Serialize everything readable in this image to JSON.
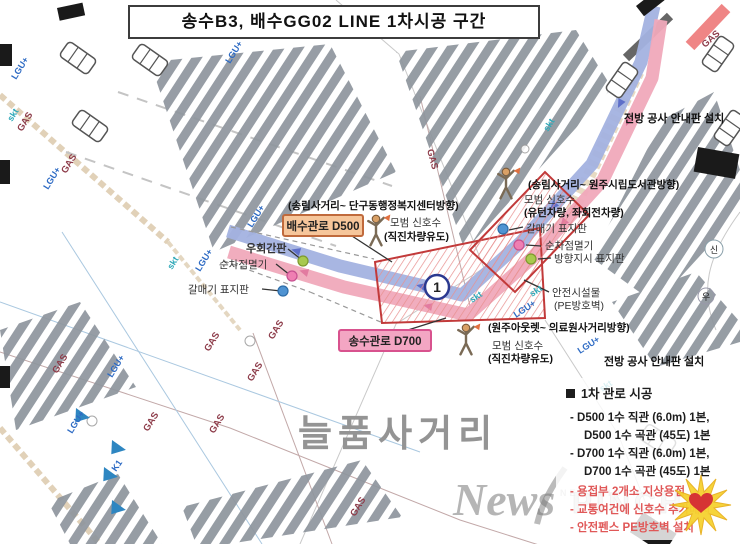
{
  "title": "송수B3, 배수GG02 LINE 1차시공 구간",
  "zone_marker": "1",
  "intersection_name": "늘품사거리",
  "labels": {
    "direction_nw": "(송림사거리~ 단구동행정복지센터방향)",
    "drain_pipe": "배수관로 D500",
    "supply_pipe": "송수관로 D700",
    "flagger_center_title": "모범 신호수",
    "flagger_center_sub": "(직진차량유도)",
    "detour_sign": "우회간판",
    "flasher_left": "순차점멸기",
    "seagull_left": "갈매기 표지판",
    "direction_ne": "(송림사거리~ 원주시립도서관방향)",
    "flagger_right_title": "모범 신호수",
    "flagger_right_sub": "(유턴차량, 좌회전차량)",
    "seagull_right": "갈매기 표지판",
    "flasher_right": "순차점멸기",
    "direction_sign_right": "방향지시 표지판",
    "safety_title": "안전시설물",
    "safety_sub": "(PE방호벽)",
    "direction_s": "(원주아웃렛~ 의료원사거리방향)",
    "flagger_bottom_title": "모범 신호수",
    "flagger_bottom_sub": "(직진차량유도)",
    "notice_top": "전방 공사 안내판 설치",
    "notice_bottom": "전방 공사 안내판 설치",
    "signal_circle": "신",
    "uturn_symbol": "우"
  },
  "legend": {
    "header": "1차 관로 시공",
    "black_items": [
      "- D500 1수 직관 (6.0m) 1본,",
      "D500 1수 곡관 (45도) 1본",
      "- D700 1수 직관 (6.0m) 1본,",
      "D700 1수 곡관 (45도) 1본"
    ],
    "red_items": [
      "- 용접부 2개소 지상용접",
      "- 교통여건에 신호수 추가배치",
      "- 안전펜스 PE방호벽 설치"
    ]
  },
  "utilities": {
    "gas": "GAS",
    "lgu": "LGU+",
    "skt": "skt",
    "k1": "K1"
  },
  "watermark": {
    "serif": "News",
    "caps": "PINCH",
    "small": "NEWSPINCH"
  },
  "colors": {
    "drain_blue": "#a3b2e0",
    "supply_pink": "#f0a9bb",
    "zone_red": "#c23a3a",
    "stripe_gray": "#8e959d",
    "label_orange": "#f6c69b",
    "label_pink": "#f3a6c3",
    "legend_red": "#e05858"
  }
}
